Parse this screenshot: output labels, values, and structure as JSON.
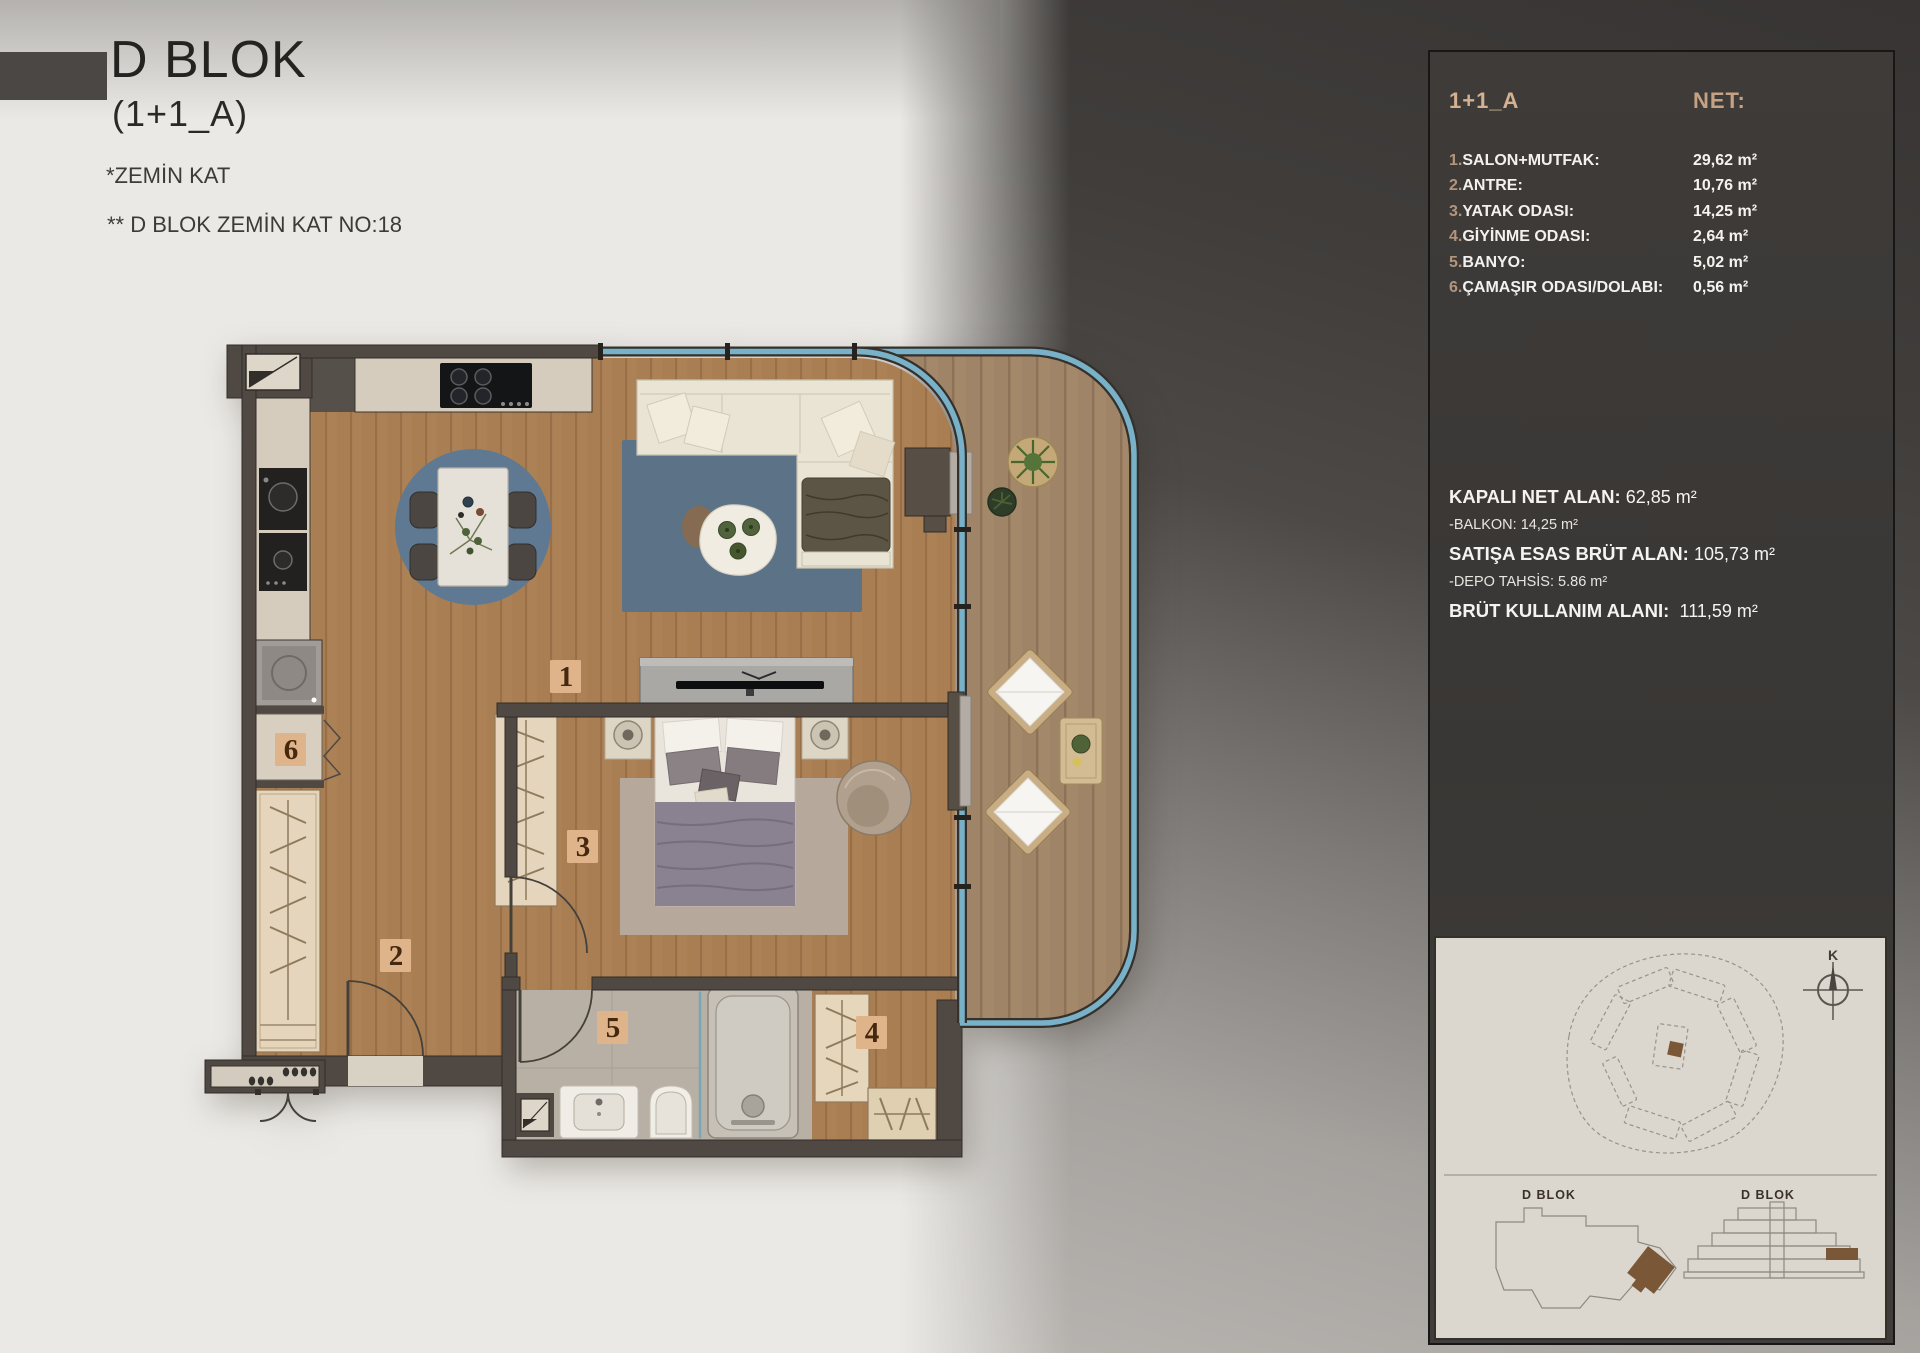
{
  "title": {
    "block": "D BLOK",
    "unit": "(1+1_A)",
    "floor_note": "*ZEMİN KAT",
    "unit_note": "** D BLOK ZEMİN KAT NO:18"
  },
  "panel": {
    "unit_label": "1+1_A",
    "net_label": "NET:",
    "rooms": [
      {
        "num": "1.",
        "name": "SALON+MUTFAK:",
        "area": "29,62 m²"
      },
      {
        "num": "2.",
        "name": "ANTRE:",
        "area": "10,76 m²"
      },
      {
        "num": "3.",
        "name": "YATAK ODASI:",
        "area": "14,25 m²"
      },
      {
        "num": "4.",
        "name": "GİYİNME ODASI:",
        "area": "2,64 m²"
      },
      {
        "num": "5.",
        "name": "BANYO:",
        "area": "5,02 m²"
      },
      {
        "num": "6.",
        "name": "ÇAMAŞIR ODASI/DOLABI:",
        "area": "0,56 m²"
      }
    ],
    "summary": [
      {
        "label": "KAPALI NET ALAN:",
        "value": "62,85 m²"
      },
      {
        "label": "-BALKON:",
        "value": "14,25 m²"
      },
      {
        "label": "SATIŞA ESAS BRÜT ALAN:",
        "value": "105,73 m²"
      },
      {
        "label": "-DEPO TAHSİS:",
        "value": "5.86 m²"
      },
      {
        "label": "BRÜT KULLANIM ALANI:",
        "value": "111,59 m²"
      }
    ],
    "site": {
      "left_block_label": "D BLOK",
      "right_block_label": "D BLOK",
      "compass_letter": "K"
    }
  },
  "plan": {
    "room_numbers": [
      "1",
      "2",
      "3",
      "4",
      "5",
      "6"
    ],
    "colors": {
      "wall": "#4f4843",
      "wood_floor": "#ad8156",
      "balcony_deck": "#a4886a",
      "window_glass": "#79b1c8",
      "rug_blue": "#5c7286",
      "bath_floor": "#b8b0a5",
      "label_bg": "#dfb48a",
      "label_text": "#45290f",
      "panel_accent": "#d3b191",
      "site_highlight": "#7a5837"
    }
  }
}
